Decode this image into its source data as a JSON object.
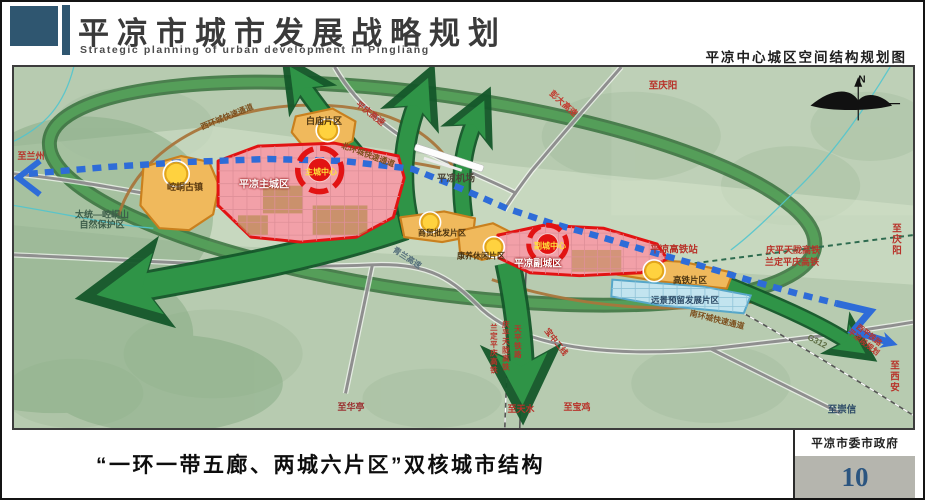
{
  "header": {
    "title_cn": "平凉市城市发展战略规划",
    "title_en": "Strategic planning of urban development in Pingliang",
    "map_subtitle": "平凉中心城区空间结构规划图"
  },
  "footer": {
    "caption": "“一环一带五廊、两城六片区”双核城市结构",
    "org": "平凉市委市政府",
    "page": "10"
  },
  "palette": {
    "header_accent": "#2f5670",
    "zone_orange": "#f0b95c",
    "zone_pink": "#f2a0a8",
    "zone_red_border": "#e21313",
    "zone_lightblue": "#c2e4ef",
    "axis_blue": "#2e6cd8",
    "corridor_green": "#2f9447",
    "node_yellow": "#ffd23f",
    "page_number_blue": "#2b5580"
  },
  "map": {
    "labels": [
      {
        "name": "label-to-lanzhou",
        "text": "至兰州",
        "x": 27,
        "y": 152,
        "color": "#b8332a",
        "size": 9,
        "rot": 0
      },
      {
        "name": "label-nature-reserve",
        "text": "太统—崆峒山\n自然保护区",
        "x": 98,
        "y": 216,
        "color": "#3c5c49",
        "size": 9,
        "rot": 0
      },
      {
        "name": "label-kongtong-ancient-town",
        "text": "崆峒古镇",
        "x": 181,
        "y": 183,
        "color": "#5a3a10",
        "size": 9,
        "rot": 0
      },
      {
        "name": "label-pingliang-main-city",
        "text": "平凉主城区",
        "x": 260,
        "y": 181,
        "color": "#ffffff",
        "size": 10,
        "rot": 0,
        "shadow": true
      },
      {
        "name": "label-main-city-center",
        "text": "主城中心",
        "x": 317,
        "y": 168,
        "color": "#ffe03a",
        "size": 8,
        "rot": 0
      },
      {
        "name": "label-baimiao-district",
        "text": "白庙片区",
        "x": 320,
        "y": 117,
        "color": "#4a3310",
        "size": 9,
        "rot": 0
      },
      {
        "name": "label-west-ring-expressway",
        "text": "西环城快速通道",
        "x": 223,
        "y": 113,
        "color": "#7c4f1d",
        "size": 8,
        "rot": -22
      },
      {
        "name": "label-north-ring-expressway",
        "text": "北环城快速通道",
        "x": 364,
        "y": 151,
        "color": "#7c4f1d",
        "size": 8,
        "rot": 20
      },
      {
        "name": "label-pingqing-expressway",
        "text": "平庆高速",
        "x": 366,
        "y": 110,
        "color": "#b5382e",
        "size": 8.5,
        "rot": 38
      },
      {
        "name": "label-pengda-expressway",
        "text": "彭大高速",
        "x": 559,
        "y": 100,
        "color": "#c23b2f",
        "size": 8.5,
        "rot": 42
      },
      {
        "name": "label-to-qingyang-north",
        "text": "至庆阳",
        "x": 659,
        "y": 83,
        "color": "#b8332a",
        "size": 9.5,
        "rot": 0
      },
      {
        "name": "label-pingliang-airport",
        "text": "平凉机场",
        "x": 452,
        "y": 176,
        "color": "#4c4538",
        "size": 9.5,
        "rot": 0
      },
      {
        "name": "label-qinglan-expressway",
        "text": "青兰高速",
        "x": 403,
        "y": 254,
        "color": "#56707c",
        "size": 8,
        "rot": 33
      },
      {
        "name": "label-trade-wholesale-district",
        "text": "商贸批发片区",
        "x": 438,
        "y": 229,
        "color": "#4a3310",
        "size": 8,
        "rot": 0
      },
      {
        "name": "label-leisure-district",
        "text": "康养休闲片区",
        "x": 477,
        "y": 252,
        "color": "#4a3310",
        "size": 8,
        "rot": 0
      },
      {
        "name": "label-pingliang-sub-city",
        "text": "平凉副城区",
        "x": 534,
        "y": 261,
        "color": "#ffffff",
        "size": 9.5,
        "rot": 0,
        "shadow": true
      },
      {
        "name": "label-sub-city-center",
        "text": "副城中心",
        "x": 546,
        "y": 242,
        "color": "#ffe03a",
        "size": 8,
        "rot": 0
      },
      {
        "name": "label-hsr-station",
        "text": "平凉高铁站",
        "x": 670,
        "y": 247,
        "color": "#b8332a",
        "size": 9.5,
        "rot": 0
      },
      {
        "name": "label-hsr-district",
        "text": "高铁片区",
        "x": 686,
        "y": 277,
        "color": "#4a3310",
        "size": 8.5,
        "rot": 0
      },
      {
        "name": "label-future-reserve-district",
        "text": "远景预留发展片区",
        "x": 681,
        "y": 297,
        "color": "#2c4a66",
        "size": 8.5,
        "rot": 0
      },
      {
        "name": "label-south-ring-expressway",
        "text": "南环城快速通道",
        "x": 713,
        "y": 316,
        "color": "#7c4f1d",
        "size": 8,
        "rot": 14
      },
      {
        "name": "label-qingping-tianlong-hsr",
        "text": "庆平天陇高铁",
        "x": 789,
        "y": 246,
        "color": "#b8332a",
        "size": 9,
        "rot": 0
      },
      {
        "name": "label-landing-pingqing-hsr",
        "text": "兰定平庆高铁",
        "x": 788,
        "y": 258,
        "color": "#b8332a",
        "size": 9,
        "rot": 0
      },
      {
        "name": "label-to-qingyang-east",
        "text": "至庆阳",
        "x": 893,
        "y": 237,
        "color": "#b8332a",
        "size": 9.5,
        "rot": 0
      },
      {
        "name": "label-g312",
        "text": "G312",
        "x": 813,
        "y": 338,
        "color": "#5e6e44",
        "size": 8.5,
        "rot": 28
      },
      {
        "name": "label-xiping-railway-plan",
        "text": "西平铁路\n平凉段规划",
        "x": 862,
        "y": 335,
        "color": "#b8332a",
        "size": 7.5,
        "rot": 38
      },
      {
        "name": "label-to-xian",
        "text": "至西安",
        "x": 891,
        "y": 374,
        "color": "#b8332a",
        "size": 9.5,
        "rot": 0
      },
      {
        "name": "label-to-chongxin",
        "text": "至崇信",
        "x": 838,
        "y": 407,
        "color": "#2c4a66",
        "size": 9.5,
        "rot": 0
      },
      {
        "name": "label-to-huating",
        "text": "至华亭",
        "x": 347,
        "y": 403,
        "color": "#9a3030",
        "size": 9,
        "rot": 0
      },
      {
        "name": "label-landing-pingqing-hsr-v",
        "text": "兰定平庆高铁",
        "x": 489,
        "y": 345,
        "color": "#b8332a",
        "size": 7.5,
        "rot": 0,
        "vertical": true
      },
      {
        "name": "label-qingping-tianlong-hsr-v",
        "text": "庆平天陇高铁",
        "x": 501,
        "y": 342,
        "color": "#b8332a",
        "size": 7.5,
        "rot": 0,
        "vertical": true
      },
      {
        "name": "label-tianping-railway-v",
        "text": "天平铁路",
        "x": 513,
        "y": 338,
        "color": "#b8332a",
        "size": 7.5,
        "rot": 0,
        "vertical": true
      },
      {
        "name": "label-baozhong-second-line",
        "text": "宝中二线",
        "x": 552,
        "y": 338,
        "color": "#b8332a",
        "size": 8,
        "rot": 52
      },
      {
        "name": "label-to-tianshui",
        "text": "至天水",
        "x": 517,
        "y": 405,
        "color": "#b8332a",
        "size": 9,
        "rot": 0
      },
      {
        "name": "label-to-baoji",
        "text": "至宝鸡",
        "x": 573,
        "y": 403,
        "color": "#b8332a",
        "size": 9,
        "rot": 0
      },
      {
        "name": "compass-n",
        "text": "N",
        "x": 858,
        "y": 76,
        "color": "#111111",
        "size": 10,
        "rot": 0
      }
    ]
  }
}
